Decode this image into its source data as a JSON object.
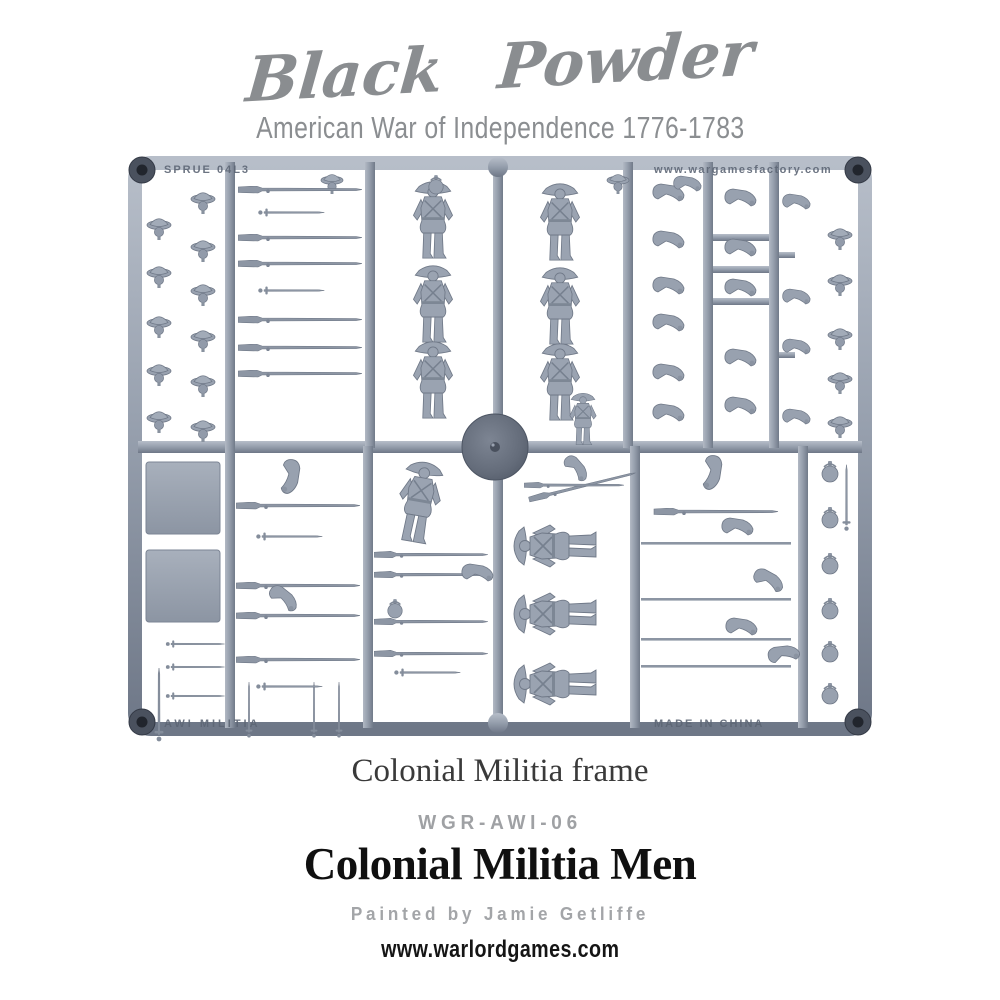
{
  "header": {
    "logo_text": "Black Powder",
    "subtitle": "American War of Independence 1776-1783"
  },
  "sprue": {
    "embossed": {
      "top_left": "SPRUE 04L3",
      "top_right": "www.wargamesfactory.com",
      "bottom_left": "AWI MILITIA",
      "bottom_right": "MADE IN CHINA"
    },
    "description": "Grey plastic sprue of Colonial Militia miniature parts: standing figure bodies, horizontal figure bodies, a running figure, muskets, bayonets and swords, bent arms, tricorn hats with heads, round canteens, two square bases and one round drum disc",
    "plastic_light": "#b7bec9",
    "plastic_mid": "#98a1af",
    "plastic_dark": "#6e7787",
    "boss_dark": "#21252d"
  },
  "captions": {
    "frame_caption": "Colonial Militia frame",
    "product_code": "WGR-AWI-06",
    "product_title": "Colonial Militia Men",
    "credit": "Painted by Jamie Getliffe",
    "website": "www.warlordgames.com"
  },
  "colors": {
    "logo_gray": "#8a8d90",
    "subtitle_gray": "#8b8e91",
    "caption_dark": "#3a3a3a",
    "code_gray": "#9fa1a4",
    "title_black": "#101010",
    "credit_gray": "#a3a5a8",
    "background": "#ffffff"
  }
}
